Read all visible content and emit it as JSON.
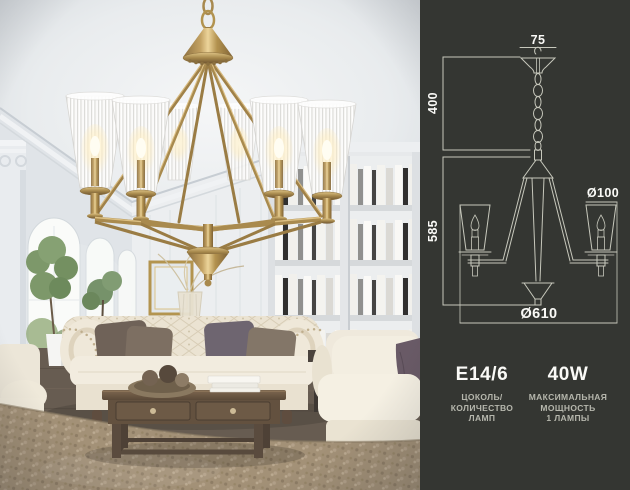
{
  "panel": {
    "diagram": {
      "dim_canopy_width": "75",
      "dim_suspension_height": "400",
      "dim_fixture_height": "585",
      "dim_shade_diameter": "Ø100",
      "dim_fixture_diameter": "Ø610"
    },
    "specs": {
      "socket": {
        "value": "E14/6",
        "caption_lines": [
          "ЦОКОЛЬ/",
          "КОЛИЧЕСТВО",
          "ЛАМП"
        ]
      },
      "power": {
        "value": "40W",
        "caption_lines": [
          "МАКСИМАЛЬНАЯ",
          "МОЩНОСТЬ",
          "1 ЛАМПЫ"
        ]
      }
    }
  },
  "colors": {
    "panel-bg": "#343632",
    "diagram-line": "#c7c8bc",
    "dim-text": "#fafaf7",
    "caption-text": "#b6b7ad",
    "brass": "#b3934f",
    "carpet": "#a29179",
    "sofa": "#efe8d9"
  }
}
